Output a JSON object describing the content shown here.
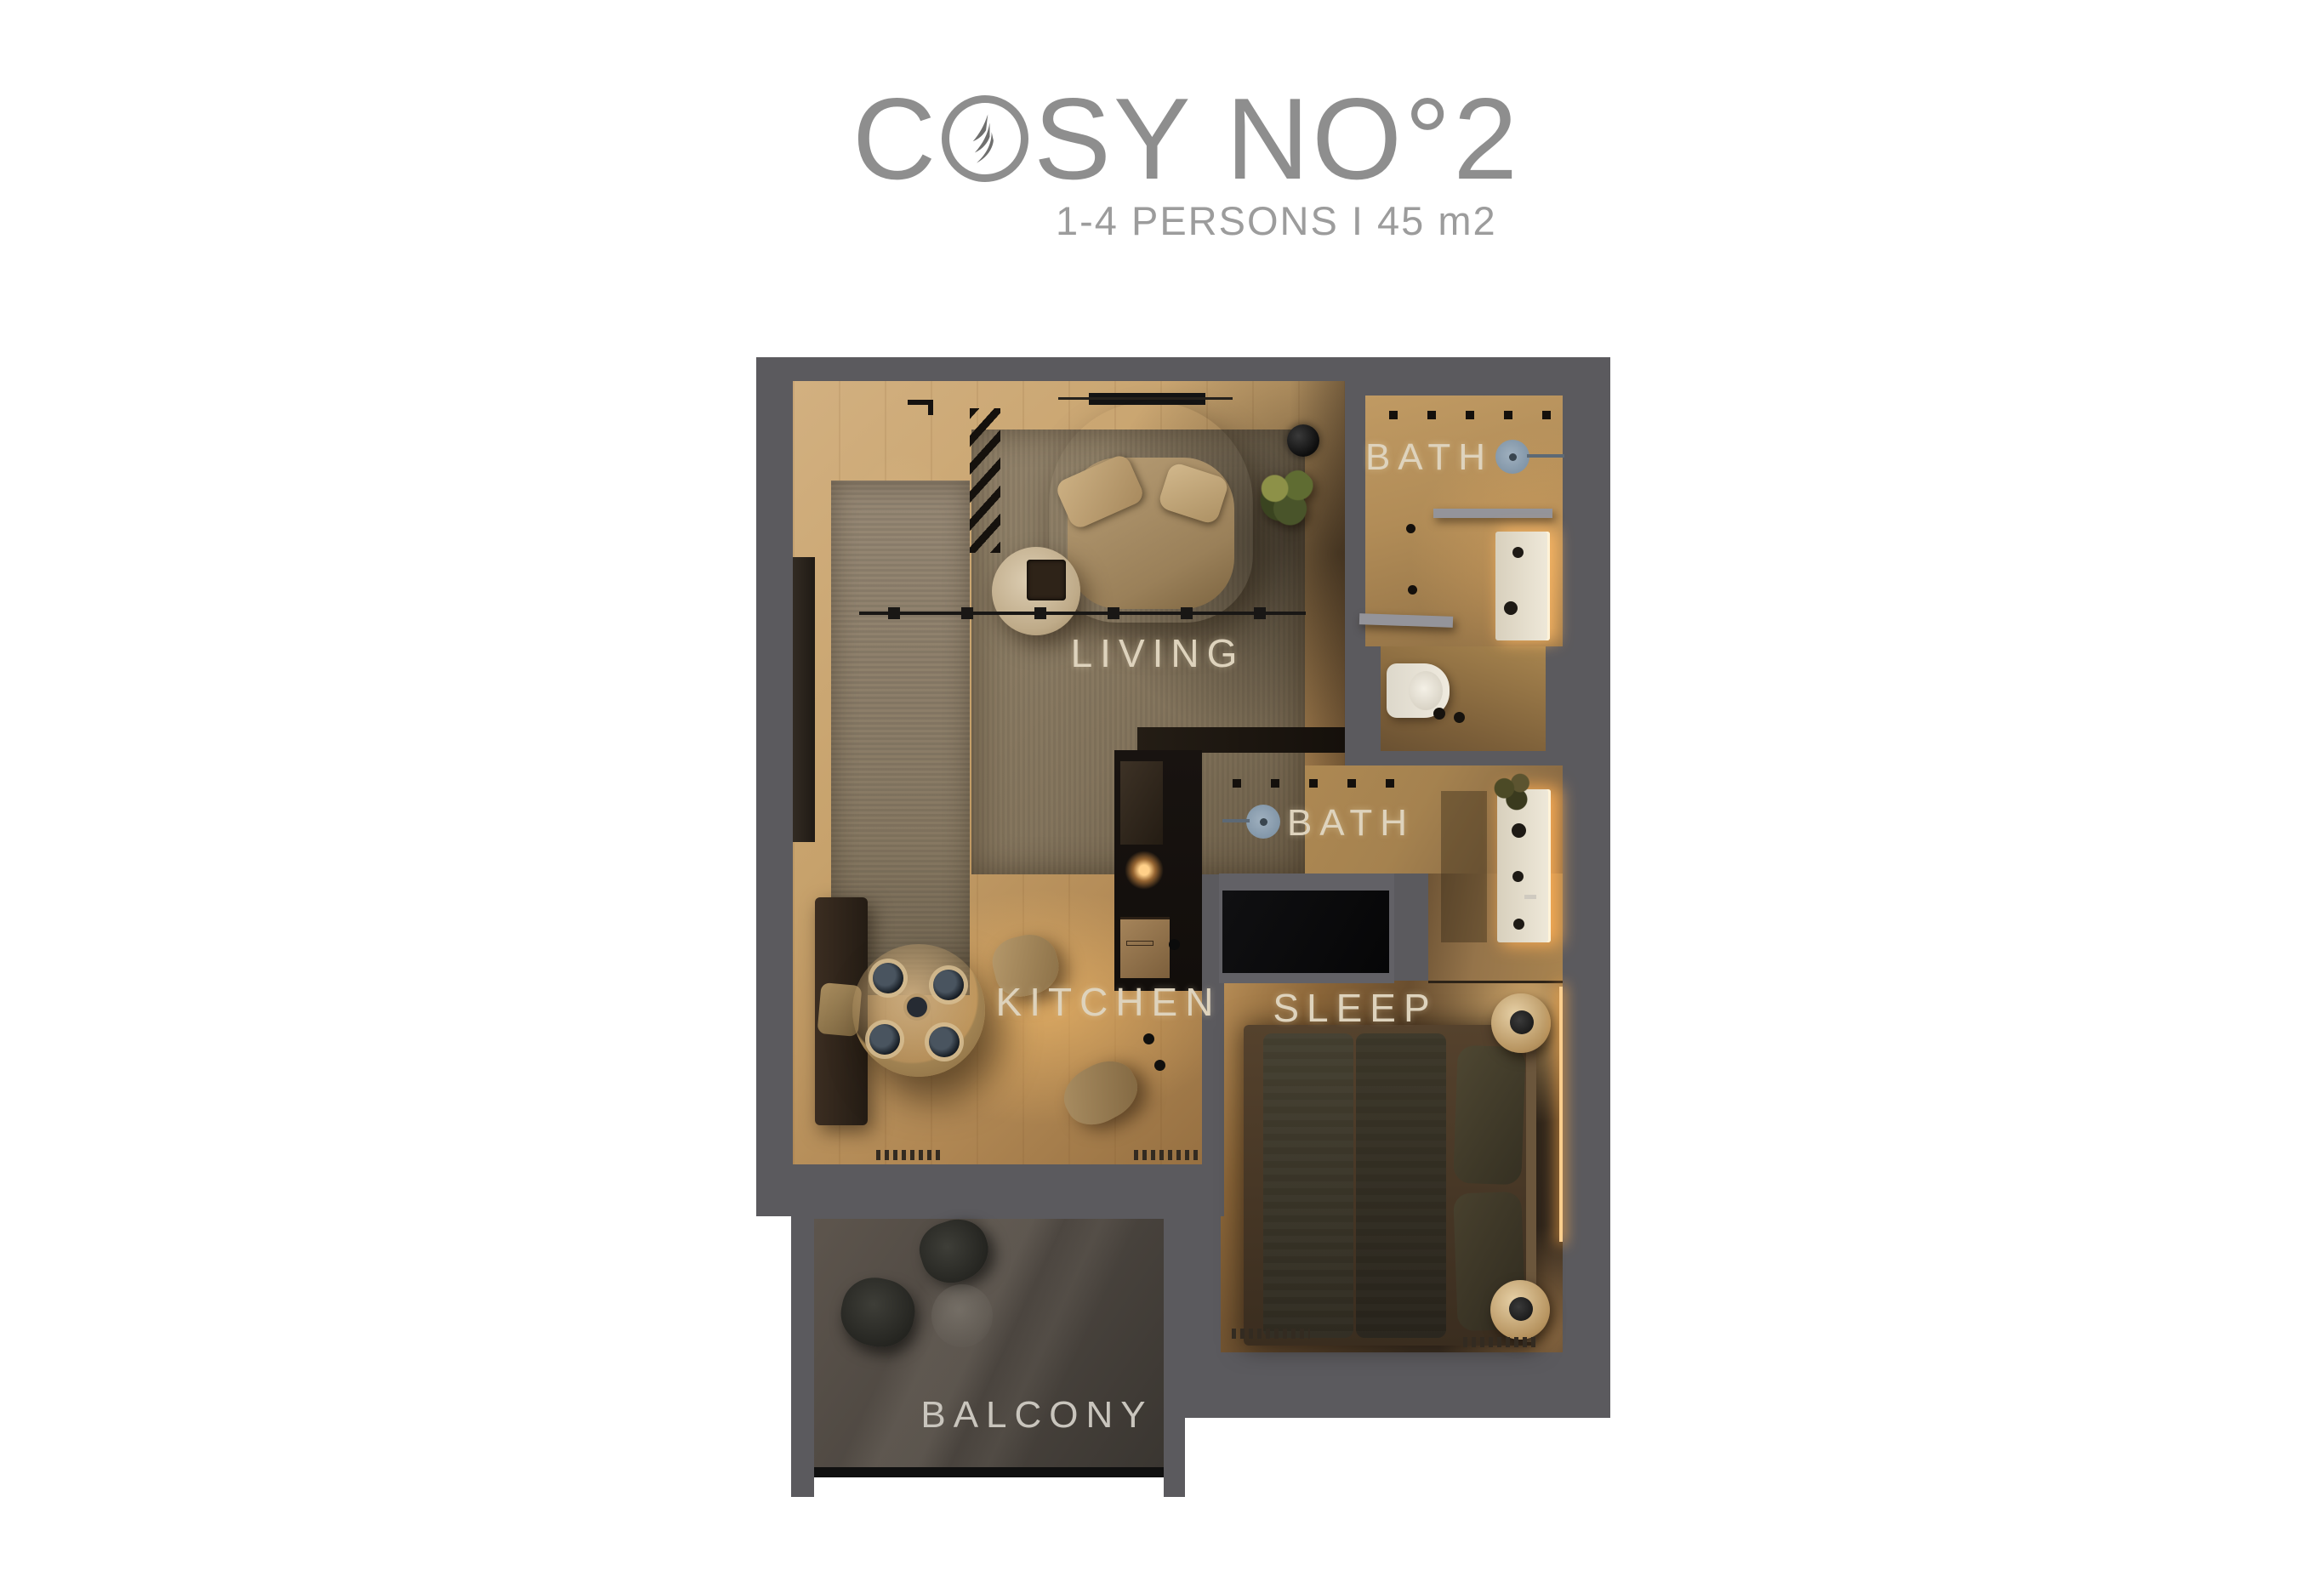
{
  "header": {
    "title_prefix": "C",
    "title_rest": "SY NO°2",
    "title_full": "COSY NO°2",
    "subtitle": "1-4 PERSONS I 45 m2",
    "brand_logo": "bird-feather-icon"
  },
  "floorplan": {
    "rooms": [
      {
        "id": "living",
        "label": "LIVING"
      },
      {
        "id": "bath-top",
        "label": "BATH"
      },
      {
        "id": "bath-lower",
        "label": "BATH"
      },
      {
        "id": "kitchen",
        "label": "KITCHEN"
      },
      {
        "id": "sleep",
        "label": "SLEEP"
      },
      {
        "id": "balcony",
        "label": "BALCONY"
      }
    ]
  },
  "colors": {
    "background": "#ffffff",
    "wall": "#5b5a5e",
    "title_text": "#8e8e8e",
    "subtitle_text": "#9c9c9c",
    "room_label": "#ded3bd",
    "wood_light": "#cfa873",
    "wood_warm": "#b98d55",
    "bath_floor": "#b2905c",
    "balcony_floor": "#4e4843",
    "shower_icon": "#8296a8",
    "led_glow": "#ffc173"
  }
}
